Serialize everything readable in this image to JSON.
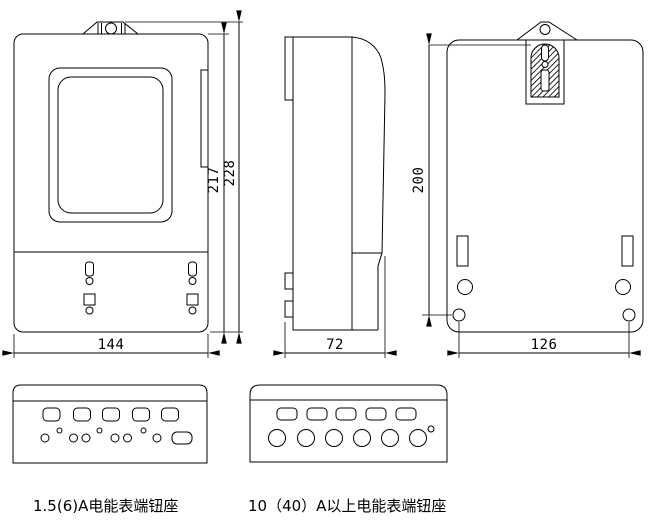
{
  "drawing": {
    "background_color": "#ffffff",
    "line_color": "#000000"
  },
  "dimensions": {
    "front_inner_height": "217",
    "front_total_height": "228",
    "front_width": "144",
    "side_depth": "72",
    "back_mount_height": "200",
    "back_mount_width": "126"
  },
  "captions": {
    "small_terminal": "1.5(6)A电能表端钮座",
    "large_terminal": "10（40）A以上电能表端钮座"
  }
}
